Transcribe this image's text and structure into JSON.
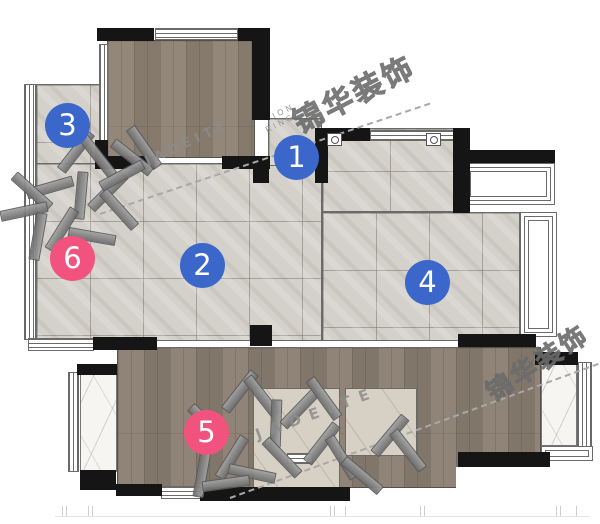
{
  "plan": {
    "markers": [
      {
        "label": "1",
        "color_name": "blue"
      },
      {
        "label": "2",
        "color_name": "blue"
      },
      {
        "label": "3",
        "color_name": "blue"
      },
      {
        "label": "4",
        "color_name": "blue"
      },
      {
        "label": "5",
        "color_name": "pink"
      },
      {
        "label": "6",
        "color_name": "pink"
      }
    ],
    "watermarks": {
      "brand_cn": "锦华装饰",
      "brand_en": "JADEITE",
      "fragment_1": "ION",
      "fragment_2": "RING"
    },
    "palette": {
      "marker_blue": "#3b67cb",
      "marker_pink": "#f2537e",
      "wall_black": "#151515",
      "wood_floor": "#8d8173",
      "tile_floor": "#d4d1cb",
      "beige_tile": "#d7d0c4",
      "marble": "#f6f5f2",
      "watermark_gray": "#6e6e6e"
    }
  }
}
